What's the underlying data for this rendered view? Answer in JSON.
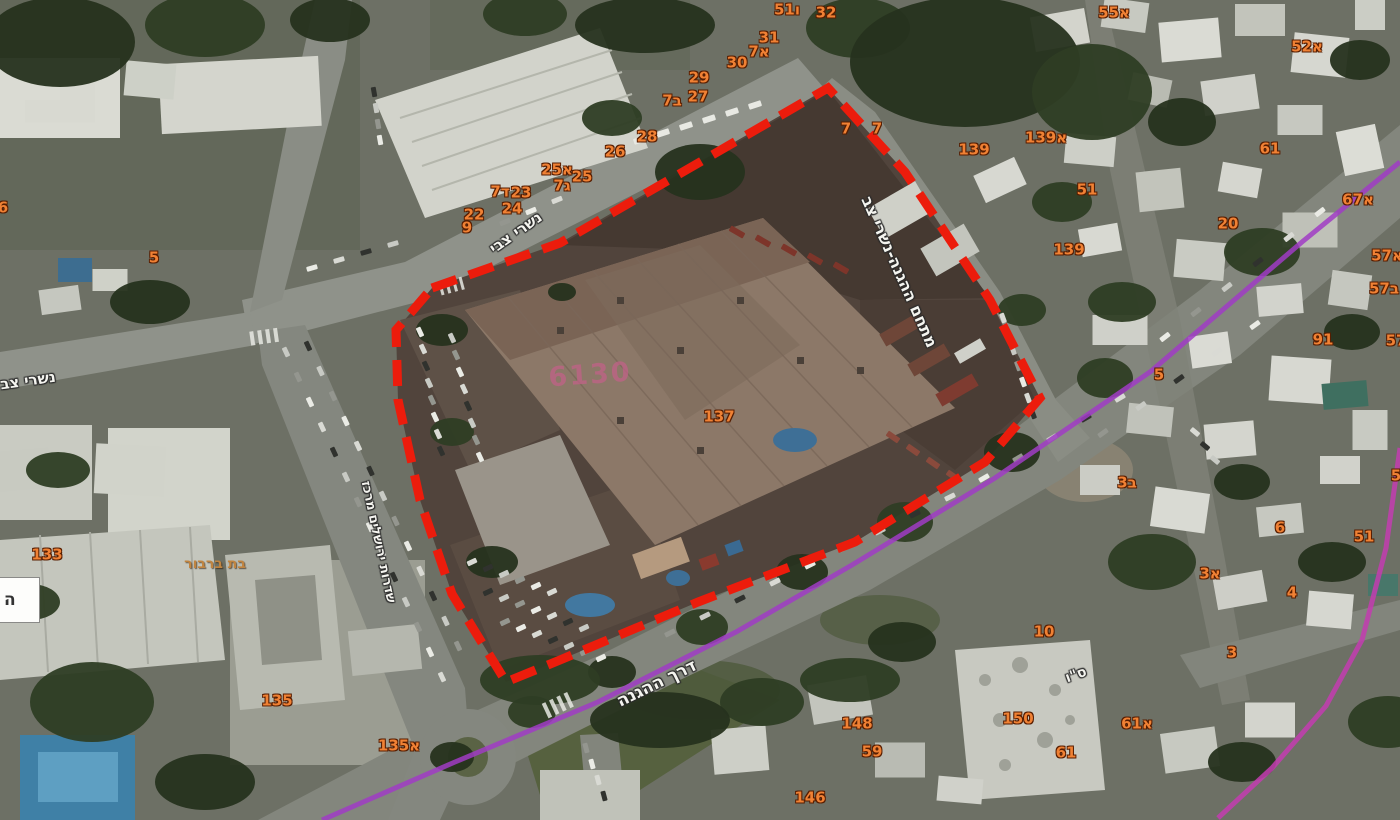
{
  "map": {
    "boundary": {
      "site_label": "מתחם ההגנה-נשרי צב",
      "block_number": "6130"
    },
    "edge_box_text": "ה",
    "place_label": {
      "text": "בת ברבור",
      "x": 215,
      "y": 564
    },
    "street_labels": [
      {
        "text": "נשרי צב",
        "x": 28,
        "y": 381,
        "angle": -8,
        "size": 15
      },
      {
        "text": "נשרי צבי",
        "x": 516,
        "y": 233,
        "angle": -35,
        "size": 15
      },
      {
        "text": "מתחם ההגנה-נשרי צב",
        "x": 899,
        "y": 272,
        "angle": 66,
        "size": 16
      },
      {
        "text": "דרך ההגנה",
        "x": 657,
        "y": 684,
        "angle": -26,
        "size": 17
      },
      {
        "text": "שדרות ירושלים מרכז",
        "x": 378,
        "y": 542,
        "angle": 78,
        "size": 13
      },
      {
        "text": "ס\"ו",
        "x": 1076,
        "y": 675,
        "angle": -20,
        "size": 14
      }
    ],
    "parcel_labels": [
      {
        "t": "51ו",
        "x": 787,
        "y": 10
      },
      {
        "t": "32",
        "x": 826,
        "y": 13
      },
      {
        "t": "31",
        "x": 769,
        "y": 38
      },
      {
        "t": "7א",
        "x": 759,
        "y": 52
      },
      {
        "t": "30",
        "x": 737,
        "y": 63
      },
      {
        "t": "29",
        "x": 699,
        "y": 78
      },
      {
        "t": "27",
        "x": 698,
        "y": 97
      },
      {
        "t": "7ב",
        "x": 672,
        "y": 101
      },
      {
        "t": "28",
        "x": 647,
        "y": 137
      },
      {
        "t": "26",
        "x": 615,
        "y": 152
      },
      {
        "t": "25א",
        "x": 557,
        "y": 170
      },
      {
        "t": "25",
        "x": 582,
        "y": 177
      },
      {
        "t": "7ג",
        "x": 562,
        "y": 186
      },
      {
        "t": "7ד",
        "x": 500,
        "y": 192
      },
      {
        "t": "23",
        "x": 521,
        "y": 193
      },
      {
        "t": "24",
        "x": 512,
        "y": 209
      },
      {
        "t": "22",
        "x": 474,
        "y": 215
      },
      {
        "t": "9",
        "x": 467,
        "y": 228
      },
      {
        "t": "7",
        "x": 846,
        "y": 129
      },
      {
        "t": "7",
        "x": 877,
        "y": 129
      },
      {
        "t": "139",
        "x": 974,
        "y": 150
      },
      {
        "t": "139א",
        "x": 1046,
        "y": 138
      },
      {
        "t": "55א",
        "x": 1114,
        "y": 13
      },
      {
        "t": "52א",
        "x": 1307,
        "y": 47
      },
      {
        "t": "61",
        "x": 1270,
        "y": 149
      },
      {
        "t": "51",
        "x": 1087,
        "y": 190
      },
      {
        "t": "67א",
        "x": 1358,
        "y": 200
      },
      {
        "t": "20",
        "x": 1228,
        "y": 224
      },
      {
        "t": "139",
        "x": 1069,
        "y": 250
      },
      {
        "t": "57א",
        "x": 1387,
        "y": 256
      },
      {
        "t": "57ב",
        "x": 1384,
        "y": 289
      },
      {
        "t": "91",
        "x": 1323,
        "y": 340
      },
      {
        "t": "57",
        "x": 1396,
        "y": 341
      },
      {
        "t": "5",
        "x": 1159,
        "y": 375
      },
      {
        "t": "5",
        "x": 1396,
        "y": 476
      },
      {
        "t": "3ב",
        "x": 1127,
        "y": 483
      },
      {
        "t": "6",
        "x": 1280,
        "y": 528
      },
      {
        "t": "51",
        "x": 1364,
        "y": 537
      },
      {
        "t": "3א",
        "x": 1210,
        "y": 574
      },
      {
        "t": "4",
        "x": 1292,
        "y": 593
      },
      {
        "t": "3",
        "x": 1232,
        "y": 653
      },
      {
        "t": "10",
        "x": 1044,
        "y": 632
      },
      {
        "t": "150",
        "x": 1018,
        "y": 719
      },
      {
        "t": "61א",
        "x": 1137,
        "y": 724
      },
      {
        "t": "61",
        "x": 1066,
        "y": 753
      },
      {
        "t": "148",
        "x": 857,
        "y": 724
      },
      {
        "t": "59",
        "x": 872,
        "y": 752
      },
      {
        "t": "146",
        "x": 810,
        "y": 798
      },
      {
        "t": "133",
        "x": 47,
        "y": 555
      },
      {
        "t": "135",
        "x": 277,
        "y": 701
      },
      {
        "t": "135א",
        "x": 399,
        "y": 746
      },
      {
        "t": "5",
        "x": 154,
        "y": 258
      },
      {
        "t": "6",
        "x": 3,
        "y": 208
      },
      {
        "t": "137",
        "x": 719,
        "y": 417
      }
    ],
    "colors": {
      "parcel_orange": "#f08134",
      "parcel_outline": "#571d00",
      "boundary_red": "#ec1c0c",
      "route_purple": "#a03cc4",
      "route_magenta": "#c33cb0",
      "street_white": "#f4f4ef",
      "block_pink": "#c06287",
      "place_bronze": "#c08440"
    }
  }
}
